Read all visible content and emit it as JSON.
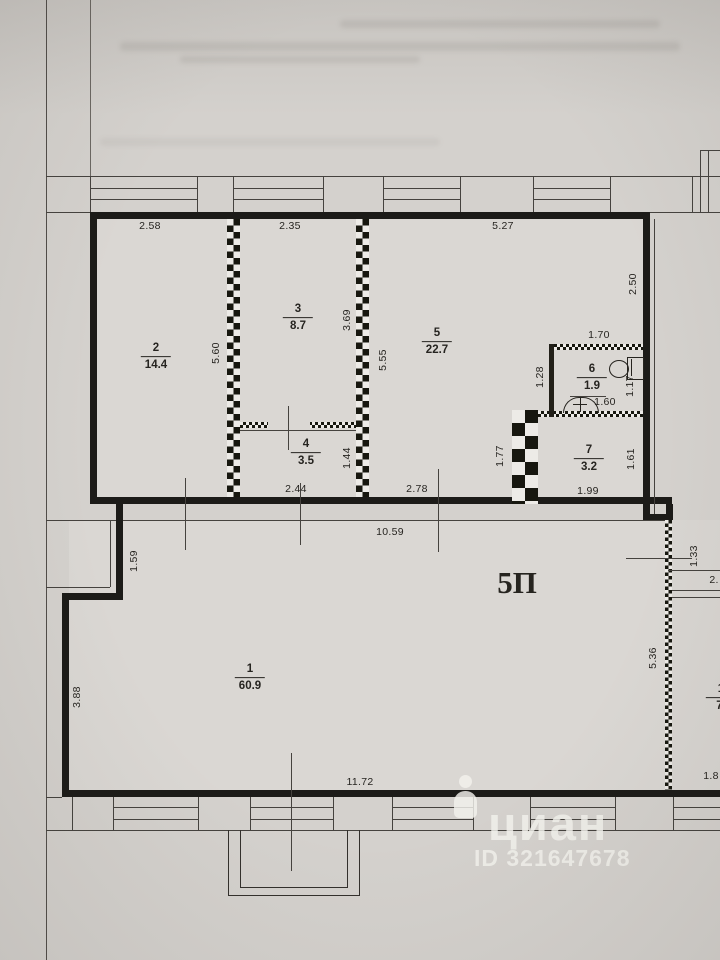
{
  "floor_plan": {
    "unit_label": "5П",
    "rooms": {
      "r1": {
        "num": "1",
        "area": "60.9"
      },
      "r2": {
        "num": "2",
        "area": "14.4"
      },
      "r3": {
        "num": "3",
        "area": "8.7"
      },
      "r4": {
        "num": "4",
        "area": "3.5"
      },
      "r5": {
        "num": "5",
        "area": "22.7"
      },
      "r6": {
        "num": "6",
        "area": "1.9"
      },
      "r7": {
        "num": "7",
        "area": "3.2"
      },
      "adjacent": {
        "num": "1",
        "area": "7."
      }
    },
    "dimensions": {
      "top_room2": "2.58",
      "top_room3": "2.35",
      "top_room5": "5.27",
      "left_room2": "5.60",
      "right_room3": "3.69",
      "left_room5": "5.55",
      "right_room5": "2.50",
      "top_room6": "1.70",
      "left_room6": "1.28",
      "right_room6": "1.17",
      "sink_room6": "1.60",
      "left_room7": "1.77",
      "right_room7": "1.61",
      "bottom_room7": "1.99",
      "bottom_room4": "2.44",
      "height_room4": "1.44",
      "bottom_hall": "2.78",
      "total_width": "10.59",
      "notch_height": "1.59",
      "left_room1": "3.88",
      "bottom_room1": "11.72",
      "right_wall": "5.36",
      "right_top": "1.33",
      "cut_right_mid": "2.",
      "cut_right_bottom": "1.8"
    },
    "watermark": {
      "brand": "циан",
      "listing_id": "ID 321647678"
    },
    "colors": {
      "paper": "#d4d1cd",
      "line": "#45423e",
      "wall": "#1c1b18",
      "watermark": "rgba(243,241,237,0.82)"
    }
  }
}
